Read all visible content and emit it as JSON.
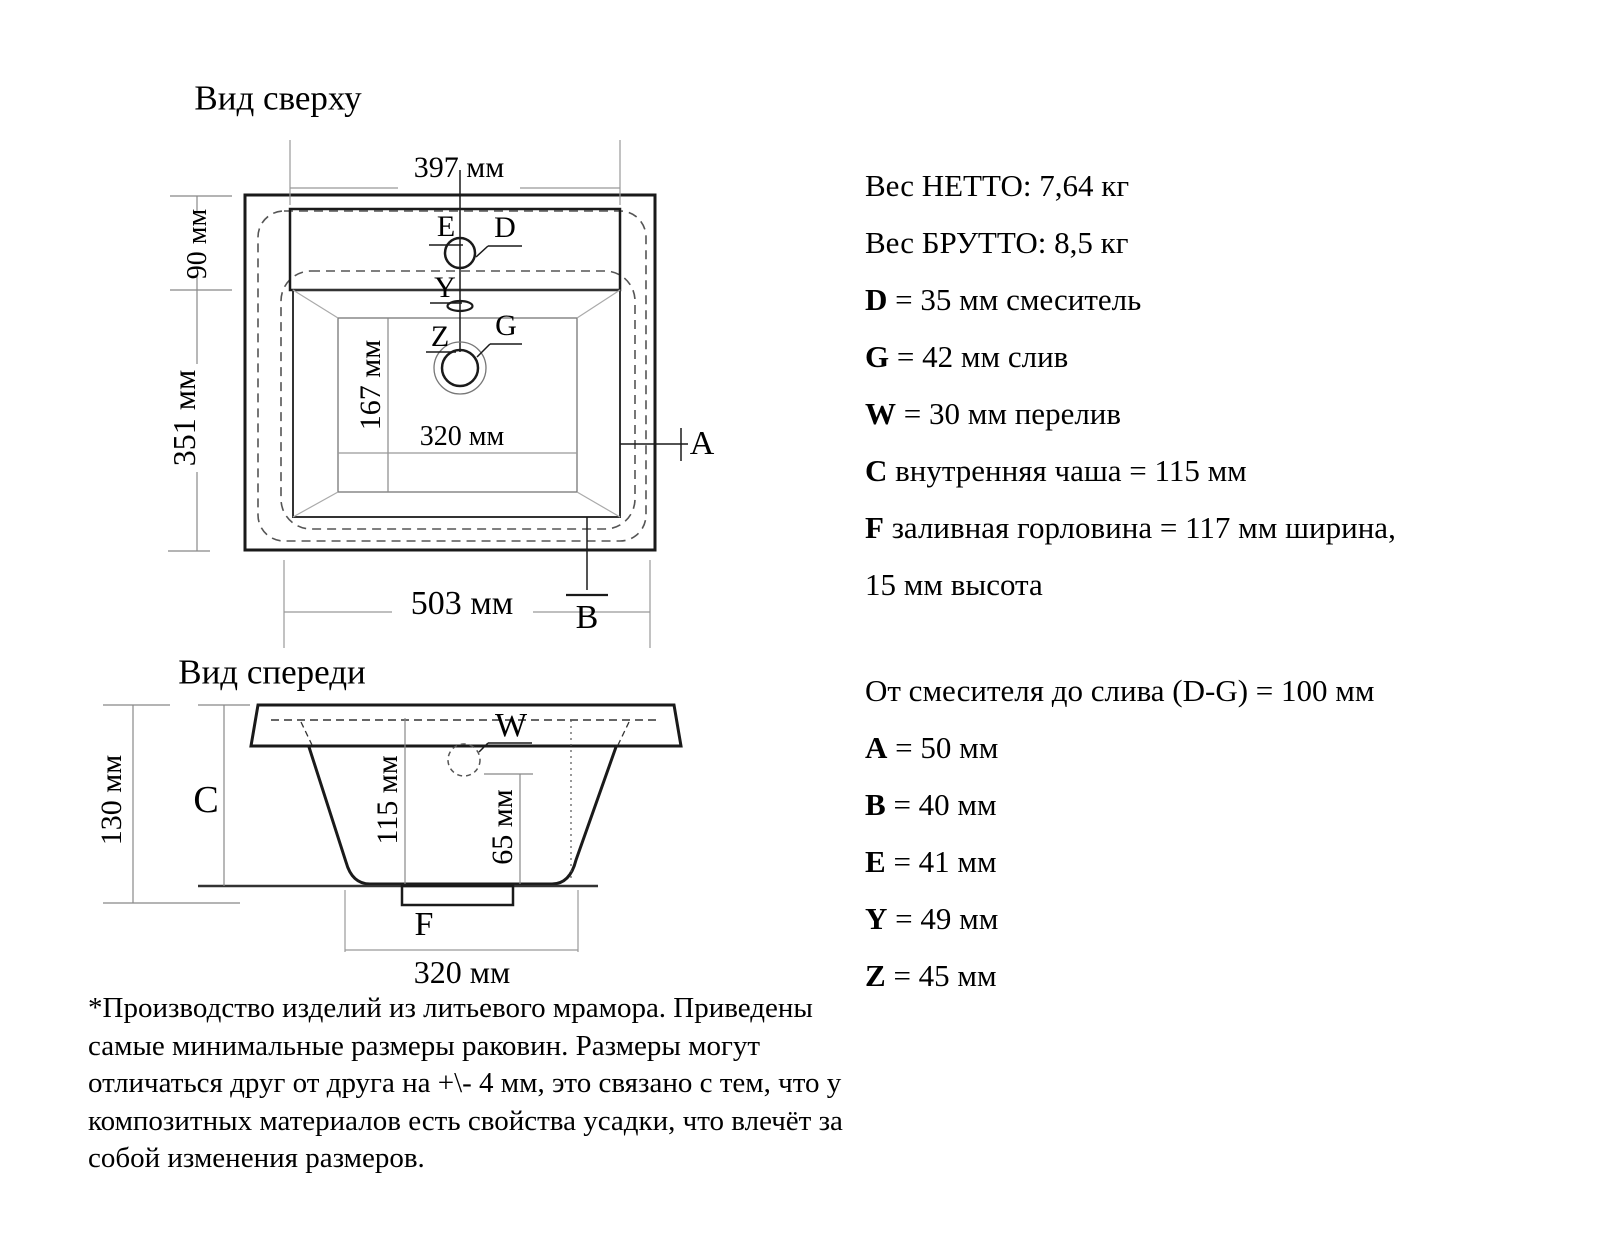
{
  "top_view": {
    "title": "Вид сверху",
    "dim_top_width": "397 мм",
    "dim_deck_depth": "90 мм",
    "dim_total_depth": "351 мм",
    "dim_inner_depth": "167 мм",
    "dim_inner_width": "320 мм",
    "dim_total_width": "503 мм",
    "labels": {
      "E": "E",
      "D": "D",
      "Y": "Y",
      "Z": "Z",
      "G": "G",
      "A": "A",
      "B": "B"
    }
  },
  "front_view": {
    "title": "Вид спереди",
    "dim_total_height": "130 мм",
    "dim_bowl_depth": "115 мм",
    "dim_overflow_height": "65 мм",
    "dim_bottom_width": "320 мм",
    "labels": {
      "C": "C",
      "W": "W",
      "F": "F"
    }
  },
  "specs": {
    "lines": [
      {
        "prefix": "",
        "text": "Вес НЕТТО: 7,64 кг"
      },
      {
        "prefix": "",
        "text": "Вес БРУТТО: 8,5 кг"
      },
      {
        "prefix": "D",
        "text": " = 35 мм смеситель"
      },
      {
        "prefix": "G",
        "text": " = 42 мм слив"
      },
      {
        "prefix": "W",
        "text": " = 30 мм перелив"
      },
      {
        "prefix": "C",
        "text": " внутренняя чаша = 115 мм"
      },
      {
        "prefix": "F",
        "text": " заливная горловина = 117 мм ширина,"
      },
      {
        "prefix": "",
        "text": "15 мм высота"
      },
      {
        "prefix": "",
        "text": "От смесителя до слива (D-G) = 100 мм"
      },
      {
        "prefix": "A",
        "text": " = 50 мм"
      },
      {
        "prefix": "B",
        "text": " = 40 мм"
      },
      {
        "prefix": "E",
        "text": " = 41 мм"
      },
      {
        "prefix": "Y",
        "text": " = 49 мм"
      },
      {
        "prefix": "Z",
        "text": " = 45 мм"
      }
    ]
  },
  "footnote": {
    "lines": [
      "*Производство изделий из литьевого мрамора. Приведены",
      "самые минимальные размеры раковин. Размеры могут",
      "отличаться друг от друга на +\\- 4 мм, это связано с тем, что у",
      "композитных материалов есть свойства усадки, что влечёт за",
      "собой изменения размеров."
    ]
  },
  "colors": {
    "main_line": "#1a1a1a",
    "dim_line": "#888888",
    "slope_line": "#aaaaaa",
    "dashed_line": "#555555",
    "background": "#ffffff"
  }
}
